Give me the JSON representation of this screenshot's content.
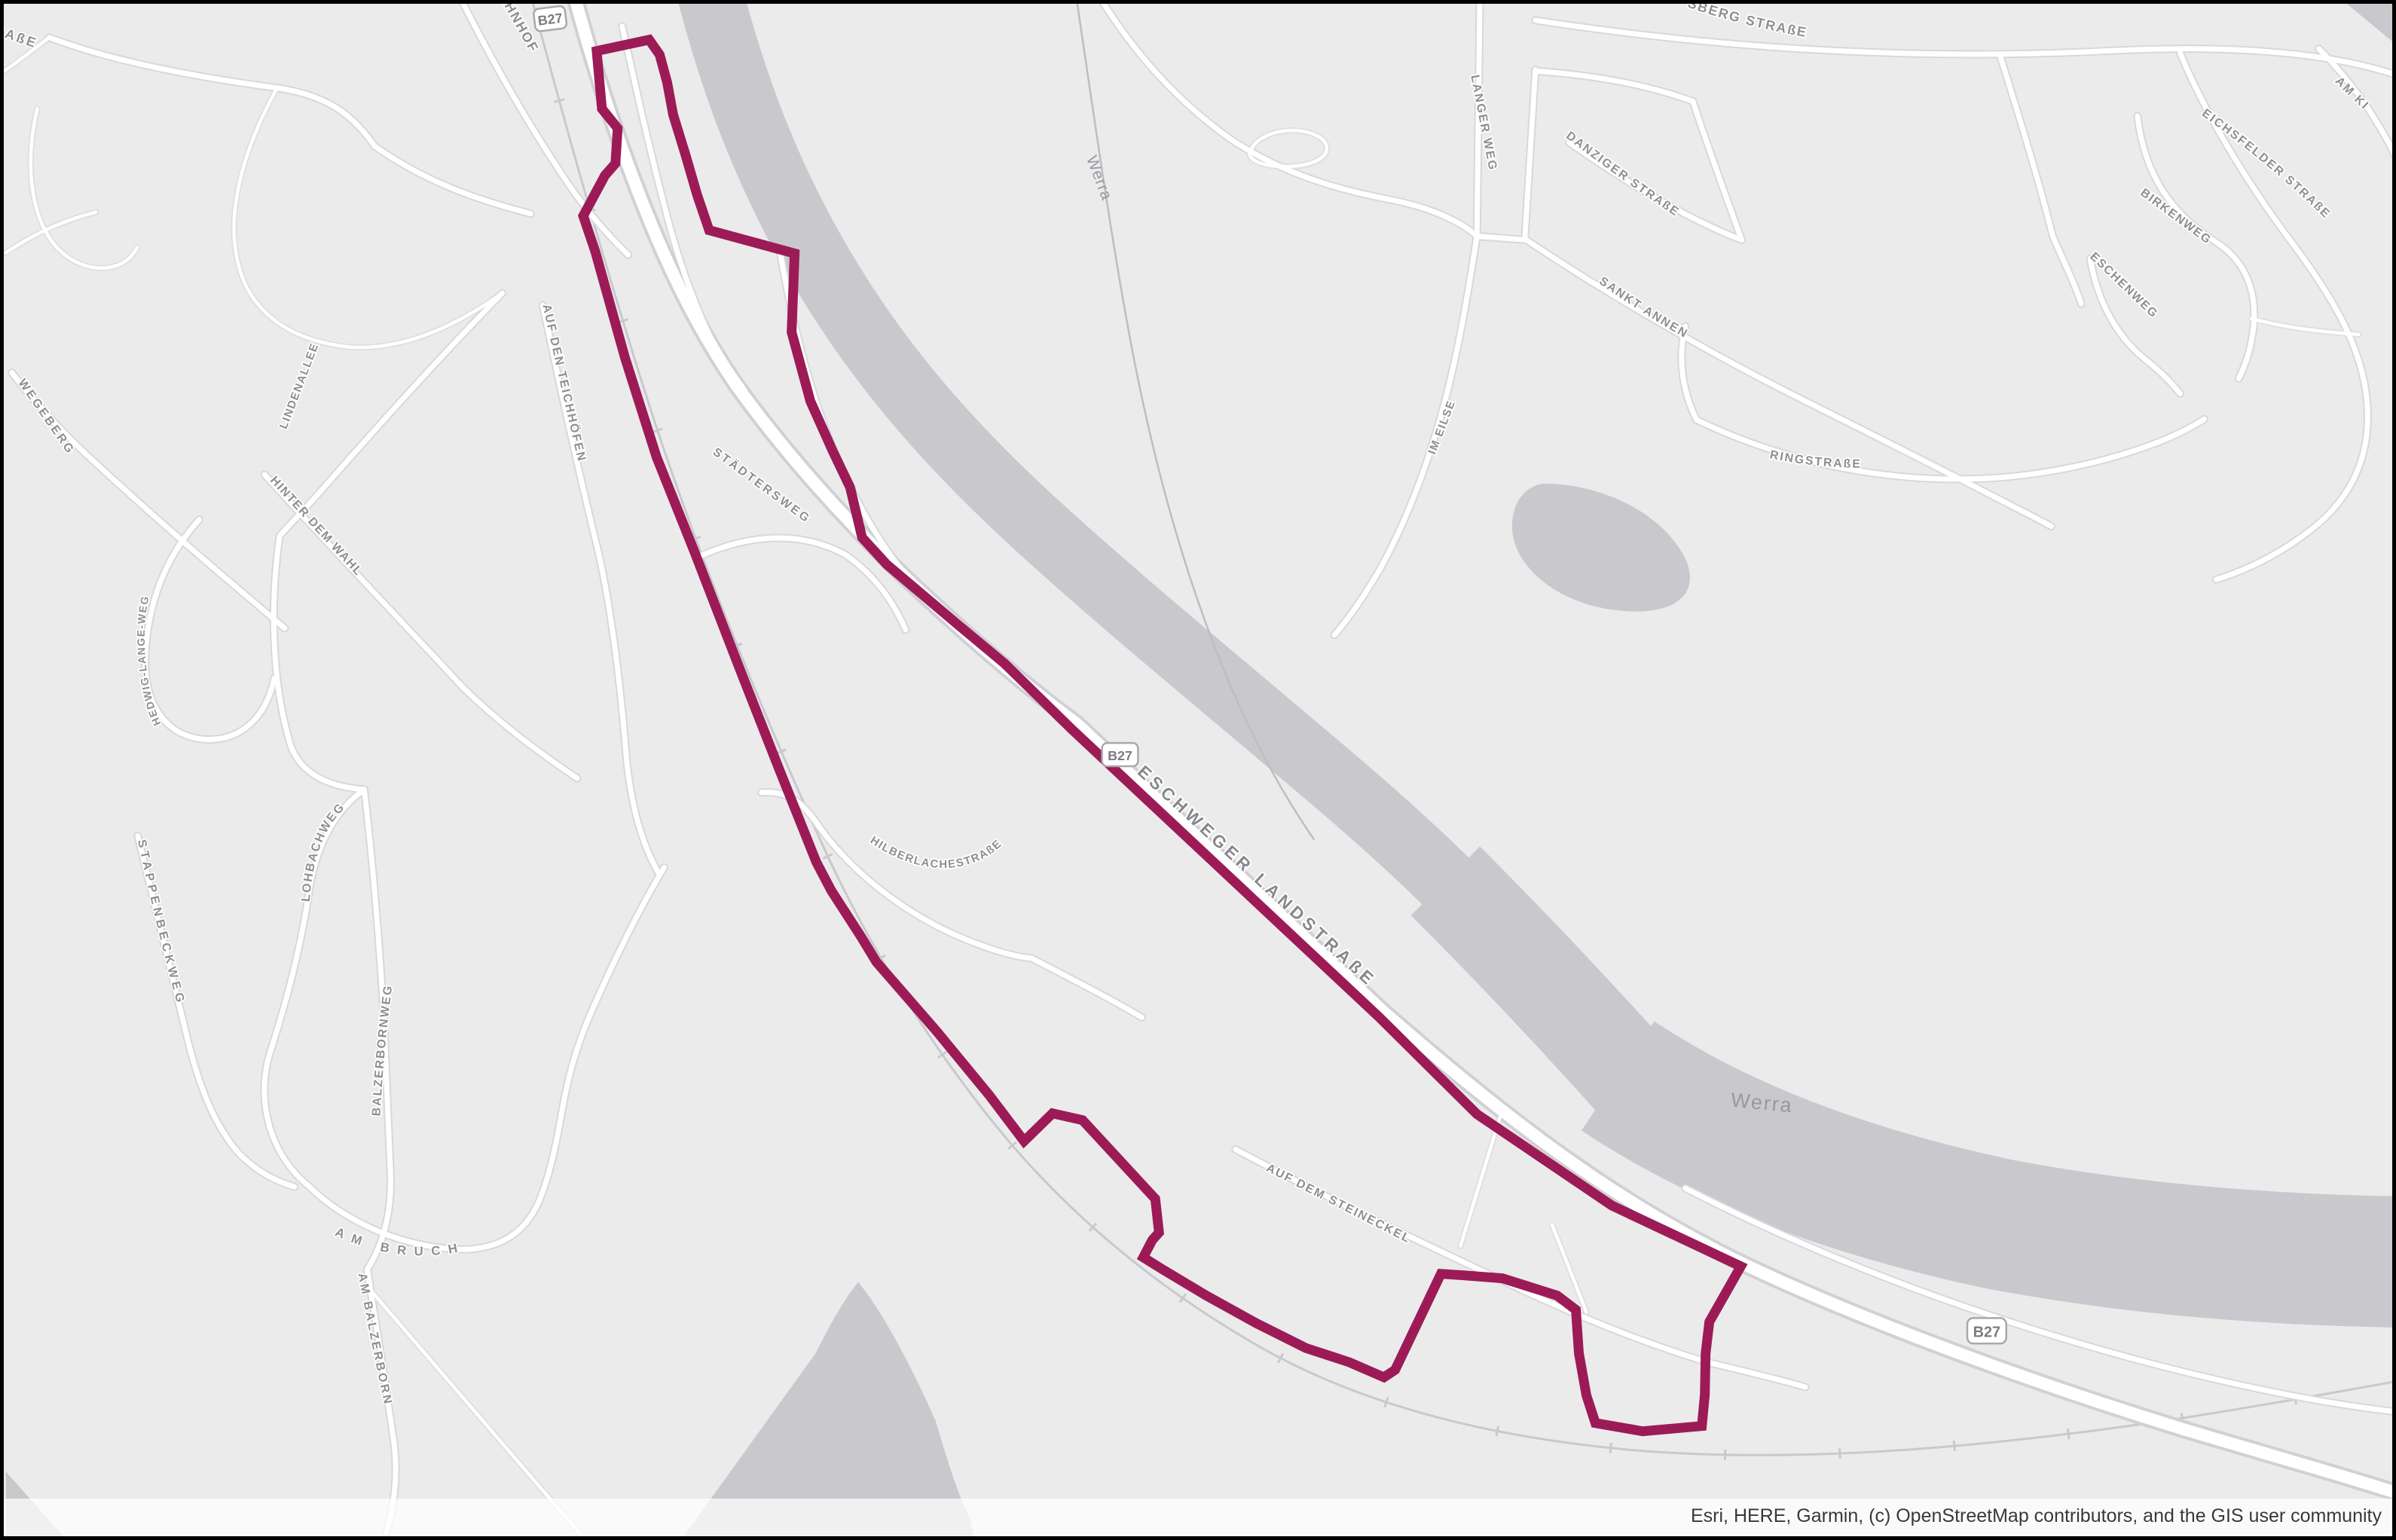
{
  "map": {
    "description": "Esri light gray canvas basemap with highlighted area boundary along the Werra river and B27",
    "attribution": "Esri, HERE, Garmin, (c) OpenStreetMap contributors, and the GIS user community",
    "colors": {
      "background": "#ebebec",
      "water": "#c8c8cd",
      "road_fill": "#ffffff",
      "road_casing": "#d6d6da",
      "boundary_highlight": "#9c1b56",
      "street_label": "#8e8e93",
      "water_label": "#98989d"
    },
    "route_shields": [
      {
        "label": "B27"
      },
      {
        "label": "B27"
      },
      {
        "label": "B27"
      }
    ],
    "water_labels": [
      {
        "text": "Werra"
      },
      {
        "text": "Werra"
      }
    ],
    "street_labels": [
      {
        "text": "STRAßE"
      },
      {
        "text": "BAHNHOF"
      },
      {
        "text": "WEGEBERG"
      },
      {
        "text": "LINDENALLEE"
      },
      {
        "text": "HINTER DEM WAHL"
      },
      {
        "text": "HEDWIG-LANGE-WEG"
      },
      {
        "text": "AUF DEN TEICHHÖFEN"
      },
      {
        "text": "STÄDTERSWEG"
      },
      {
        "text": "HILBERLACHESTRAßE"
      },
      {
        "text": "LOHBACHWEG"
      },
      {
        "text": "STAPPENBECKWEG"
      },
      {
        "text": "BALZERBORNWEG"
      },
      {
        "text": "AM BRUCH"
      },
      {
        "text": "AM BALZERBORN"
      },
      {
        "text": "ESCHWEGER LANDSTRAßE"
      },
      {
        "text": "AUF DEM STEINECKEL"
      },
      {
        "text": "LANGER WEG"
      },
      {
        "text": "IM EILSE"
      },
      {
        "text": "DANZIGER STRAßE"
      },
      {
        "text": "SANKT ANNEN"
      },
      {
        "text": "RINGSTRAßE"
      },
      {
        "text": "SBERG STRAßE"
      },
      {
        "text": "EICHSFELDER STRAßE"
      },
      {
        "text": "BIRKENWEG"
      },
      {
        "text": "ESCHENWEG"
      },
      {
        "text": "AM KI"
      }
    ]
  }
}
